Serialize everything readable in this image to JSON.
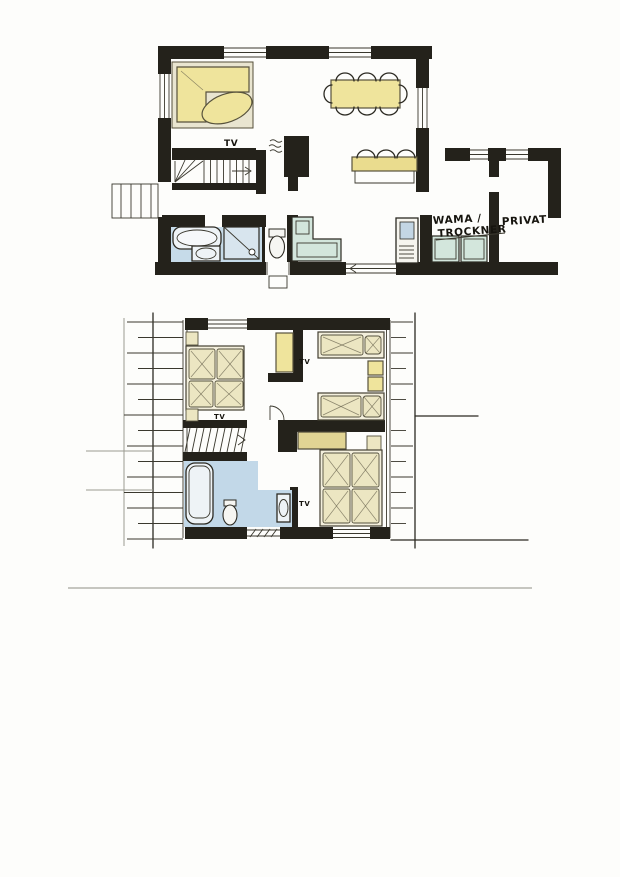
{
  "labels": {
    "tv": "TV",
    "utility_line1": "WAMA /",
    "utility_line2": "TROCKNER",
    "privat": "PRIVAT"
  },
  "colors": {
    "wall_ink": "#24221b",
    "furniture_yellow": "#efe49c",
    "closet_tan": "#e1d494",
    "bed_linen": "#ece6c2",
    "bathroom_blue": "#c6dbe9",
    "appliance_teal": "#d3e6dc",
    "paper": "#fdfdfb",
    "divider_gray": "#b4b4ac"
  }
}
